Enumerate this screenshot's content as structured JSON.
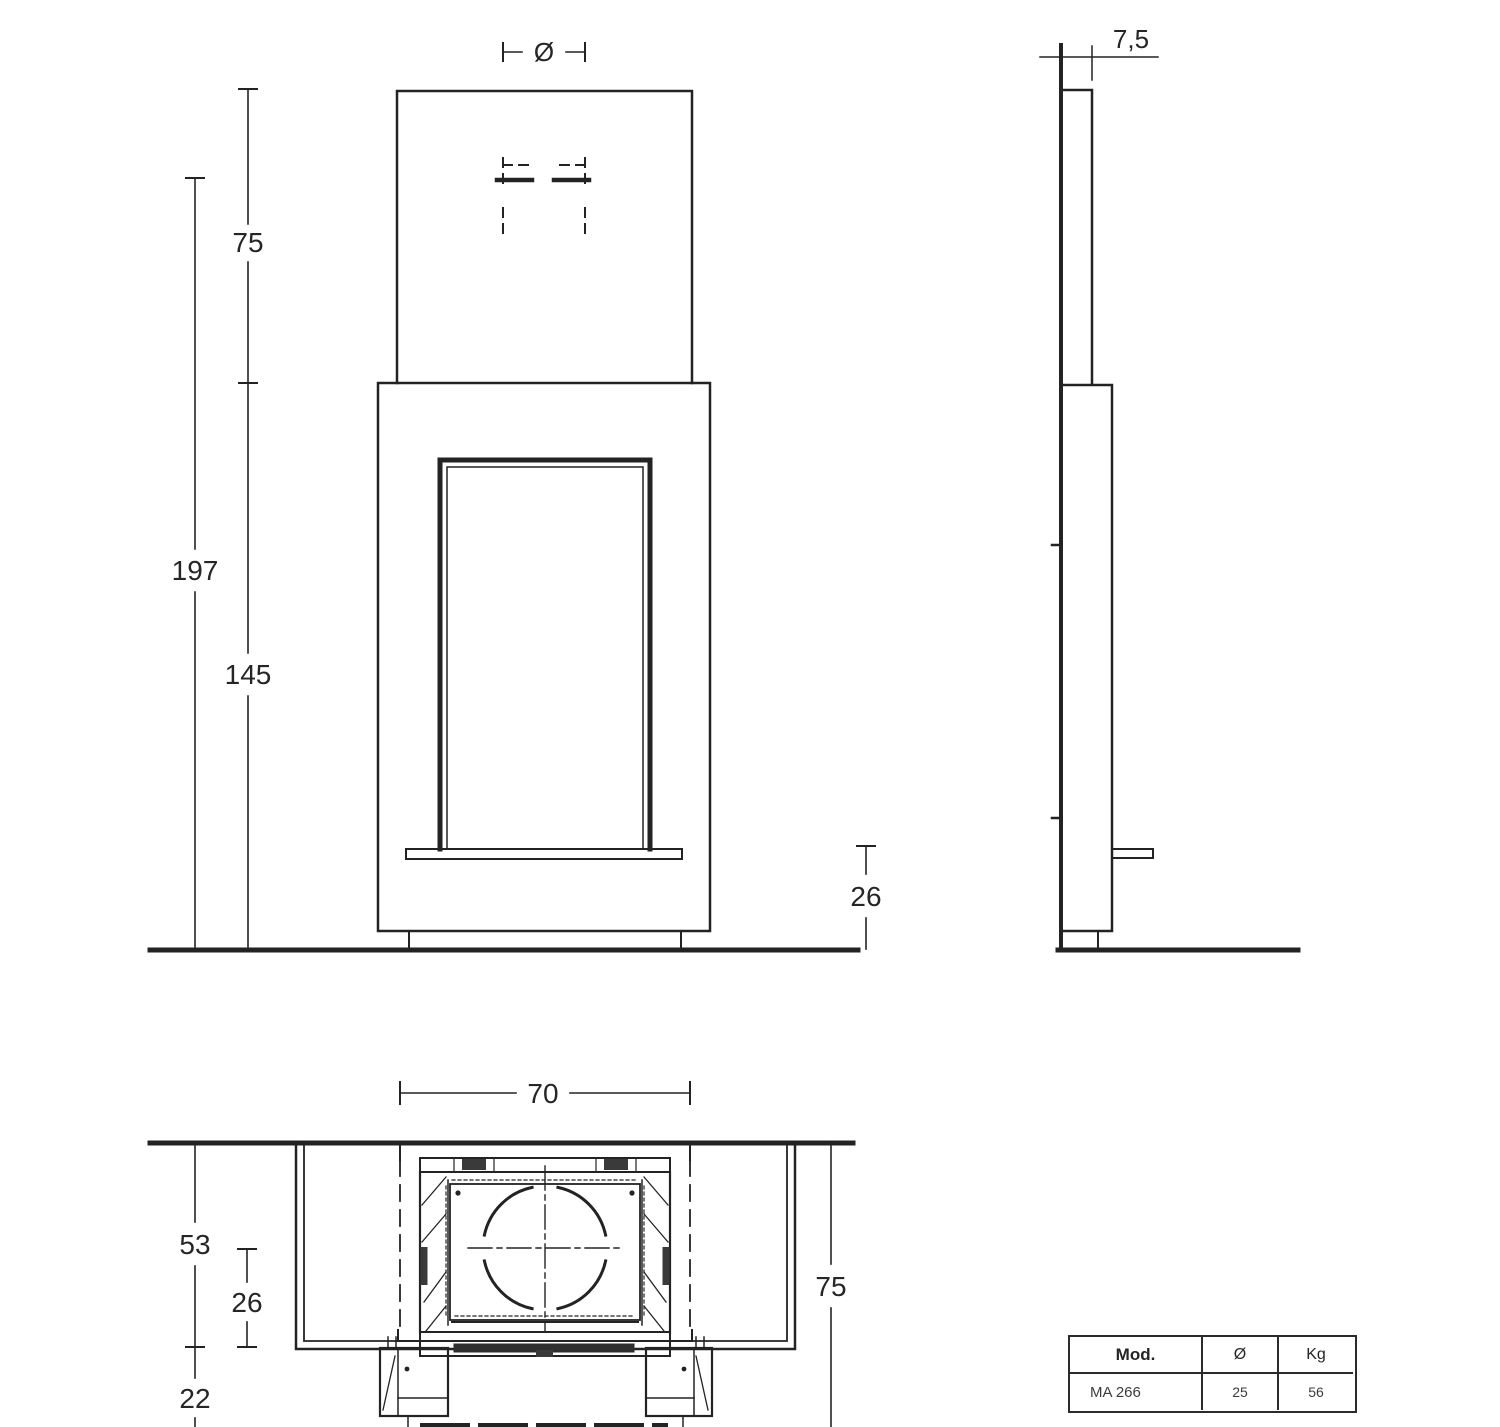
{
  "drawing": {
    "line_color": "#232323",
    "background": "#ffffff",
    "dimensions": {
      "front": {
        "flue_diameter": "Ø",
        "upper_section_height": "75",
        "total_height": "197",
        "body_height": "145",
        "base_height": "26"
      },
      "side": {
        "wall_offset_depth": "7,5"
      },
      "plan": {
        "front_width": "70",
        "total_depth": "53",
        "firebox_depth": "26",
        "feet_depth": "22",
        "side_dimension": "75"
      }
    }
  },
  "spec_table": {
    "headers": [
      "Mod.",
      "Ø",
      "Kg"
    ],
    "rows": [
      [
        "MA 266",
        "25",
        "56"
      ]
    ]
  }
}
